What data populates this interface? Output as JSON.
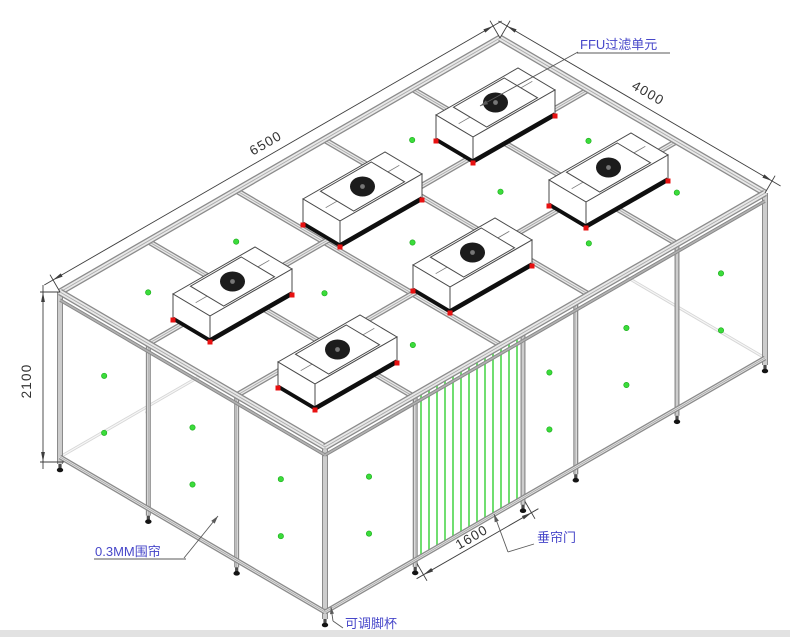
{
  "drawing": {
    "callouts": {
      "ffu_unit": "FFU过滤单元",
      "enclosure_curtain": "0.3MM围帘",
      "curtain_door": "垂帘门",
      "adjustable_foot": "可调脚杯"
    },
    "dimensions": {
      "length": "6500",
      "width": "4000",
      "height": "2100",
      "door_width": "1600"
    },
    "counts": {
      "ffu_units": 6,
      "door_curtain_strips": 13
    },
    "colors": {
      "background": "#ffffff",
      "callout_text": "#4747c9",
      "callout_line": "#5a5a5a",
      "dimension_text": "#333333",
      "dimension_line": "#3d3d3d",
      "beam_edge": "#8b8b8b",
      "beam_fill": "#e9e9e9",
      "beam_center": "#ababab",
      "outline": "#4a4a4a",
      "panel_dot_green": "#3bdc3b",
      "panel_dot_edge": "#18aa18",
      "ffu_corner_red": "#e81111",
      "ffu_fan_dark": "#1c1c1c",
      "curtain_strip_green": "#58d858",
      "back_structure": "#a5a5a5",
      "foot_dark": "#141414",
      "bottom_border": "#e2e2e2"
    }
  }
}
